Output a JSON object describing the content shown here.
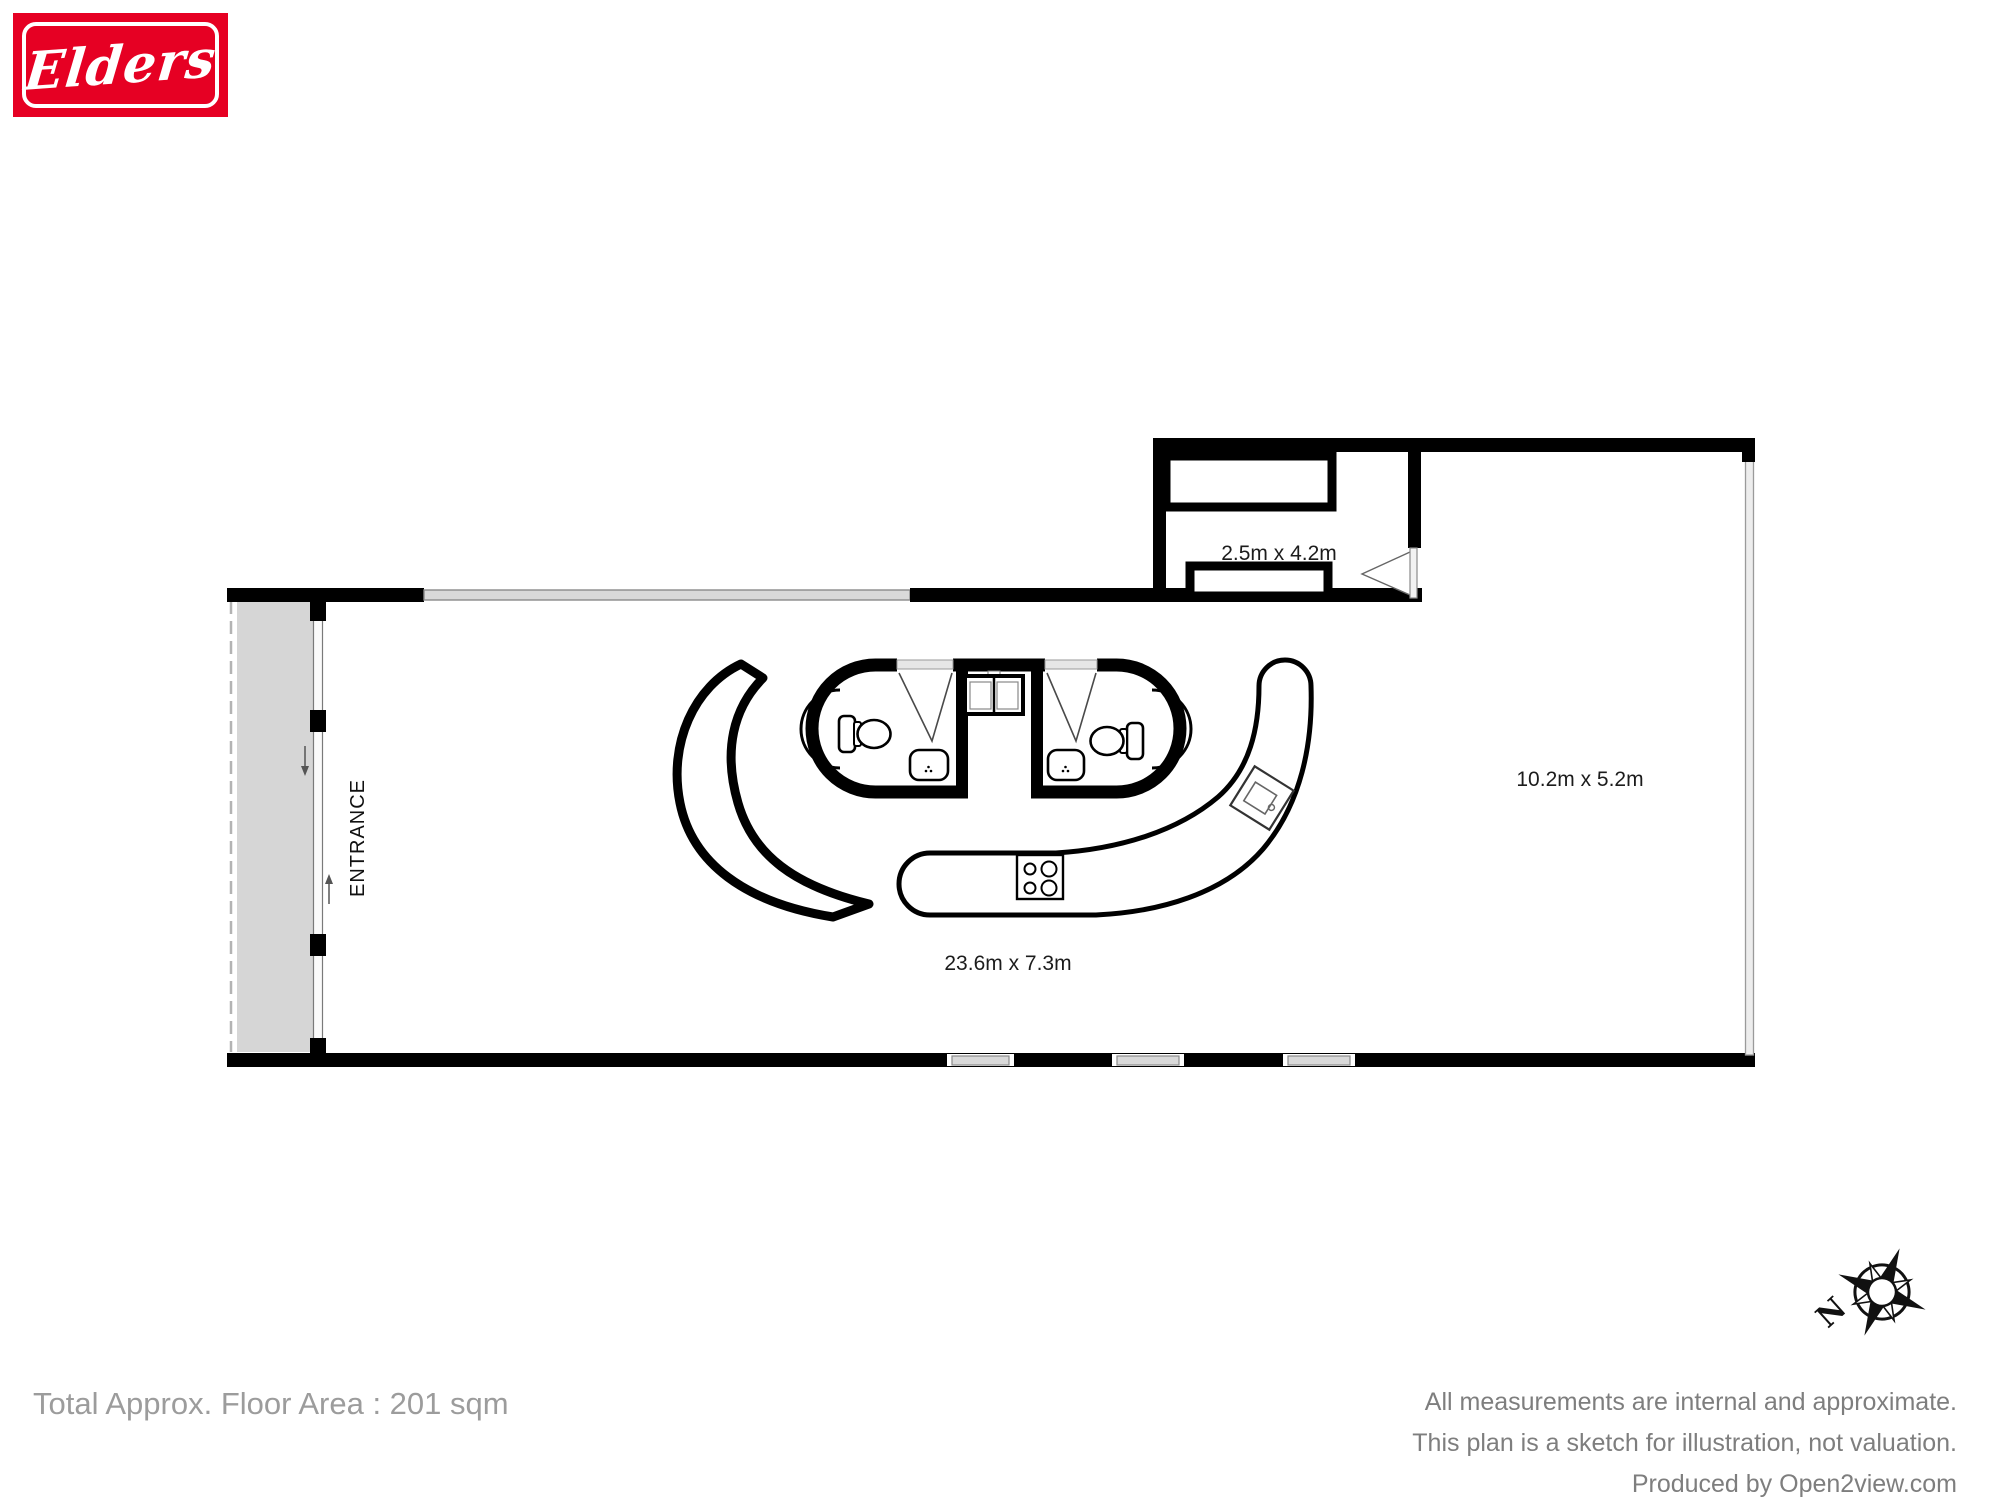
{
  "logo": {
    "brand": "Elders",
    "background": "#e60023"
  },
  "plan": {
    "entrance_label": "ENTRANCE",
    "rooms": [
      {
        "id": "small-room",
        "label": "2.5m x 4.2m"
      },
      {
        "id": "right-area",
        "label": "10.2m x 5.2m"
      },
      {
        "id": "main-room",
        "label": "23.6m x 7.3m"
      }
    ],
    "compass": {
      "north_label": "N"
    }
  },
  "footer": {
    "total_area": "Total Approx. Floor Area : 201 sqm",
    "disclaimer_line1": "All measurements are internal and approximate.",
    "disclaimer_line2": "This plan is a sketch for illustration, not valuation.",
    "producer": "Produced by Open2view.com"
  },
  "colors": {
    "wall": "#000000",
    "window_fill": "#d9d9d9",
    "porch_fill": "#d6d6d6",
    "text_gray_left": "#9c9c9c",
    "text_gray_right": "#7e7e7e"
  }
}
